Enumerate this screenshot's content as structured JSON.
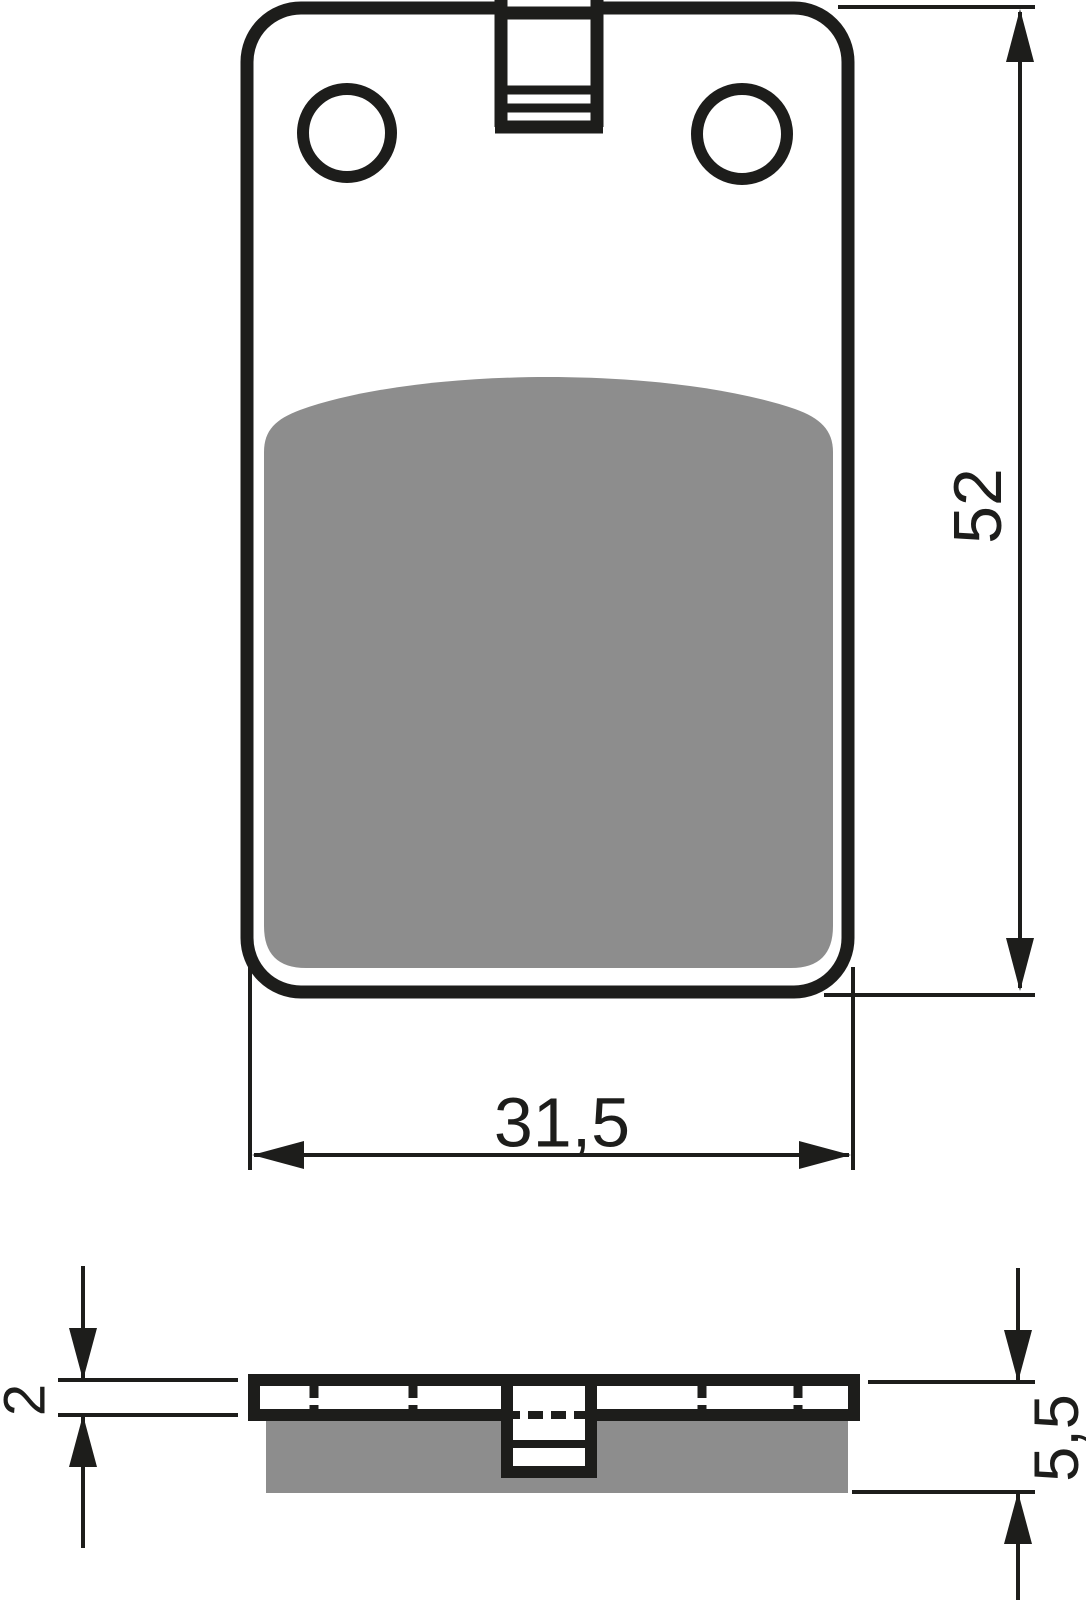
{
  "drawing": {
    "subject": "brake-pad-technical-drawing",
    "views": {
      "front": "front view with mounting holes, tab and friction pad",
      "side": "side profile view with backing plate and friction material"
    },
    "dimensions": {
      "height": {
        "value": "52"
      },
      "width": {
        "value": "31,5"
      },
      "backing_thickness": {
        "value": "2"
      },
      "total_thickness": {
        "value": "5,5"
      }
    },
    "colors": {
      "line": "#1d1d1b",
      "pad_fill": "#8d8d8d",
      "background": "#ffffff"
    }
  }
}
